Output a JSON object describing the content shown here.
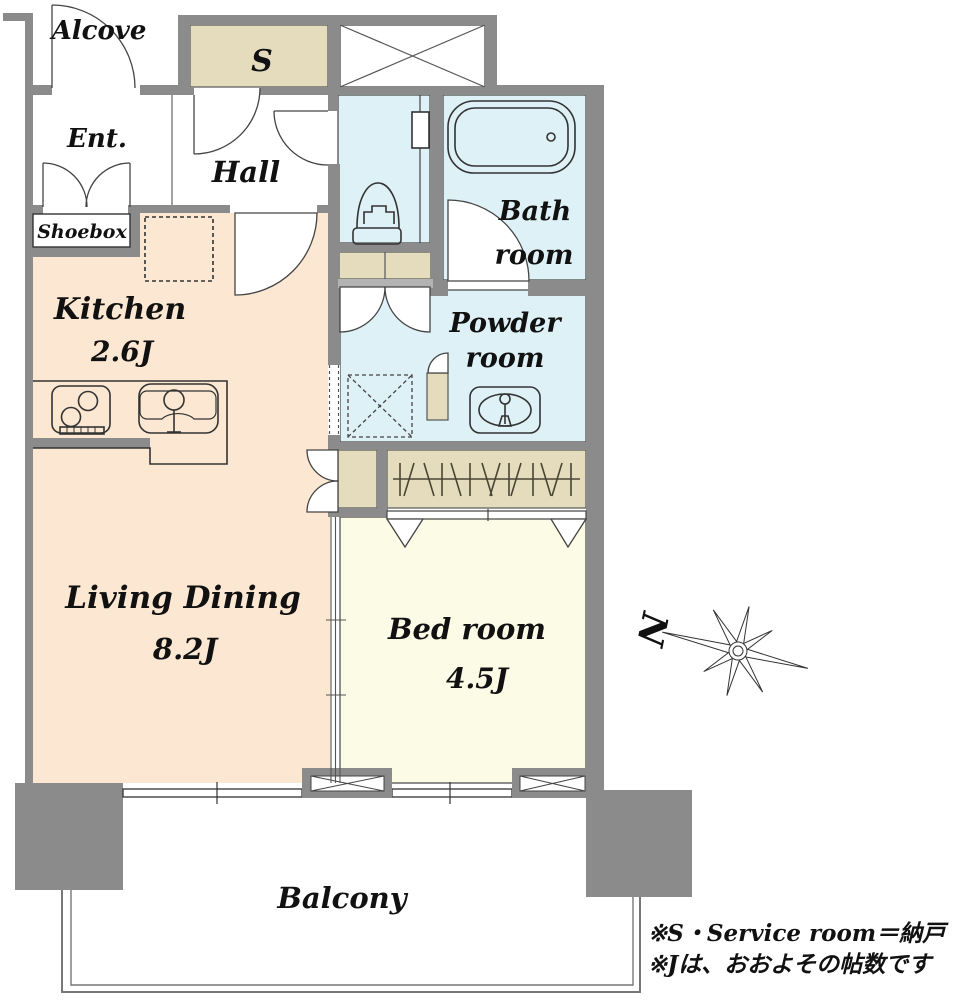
{
  "plan": {
    "rooms": {
      "alcove": {
        "label": "Alcove"
      },
      "service_room": {
        "label": "S"
      },
      "entrance": {
        "label": "Ent."
      },
      "hall": {
        "label": "Hall"
      },
      "shoebox": {
        "label": "Shoebox"
      },
      "kitchen": {
        "label": "Kitchen",
        "size": "2.6J"
      },
      "bath": {
        "line1": "Bath",
        "line2": "room"
      },
      "powder": {
        "line1": "Powder",
        "line2": "room"
      },
      "living_dining": {
        "label": "Living Dining",
        "size": "8.2J"
      },
      "bedroom": {
        "label": "Bed room",
        "size": "4.5J"
      },
      "balcony": {
        "label": "Balcony"
      }
    },
    "compass": {
      "north_label": "N"
    },
    "notes": {
      "line1": "※S・Service room＝納戸",
      "line2": "※Jは、おおよその帖数です"
    },
    "colors": {
      "wall": "#8b8b8b",
      "wall_light": "#b3b3b3",
      "floor_main": "#fce8d2",
      "floor_bedroom": "#fcfbe6",
      "floor_wet": "#def1f6",
      "storage": "#e5dcbe",
      "line": "#333333"
    }
  }
}
